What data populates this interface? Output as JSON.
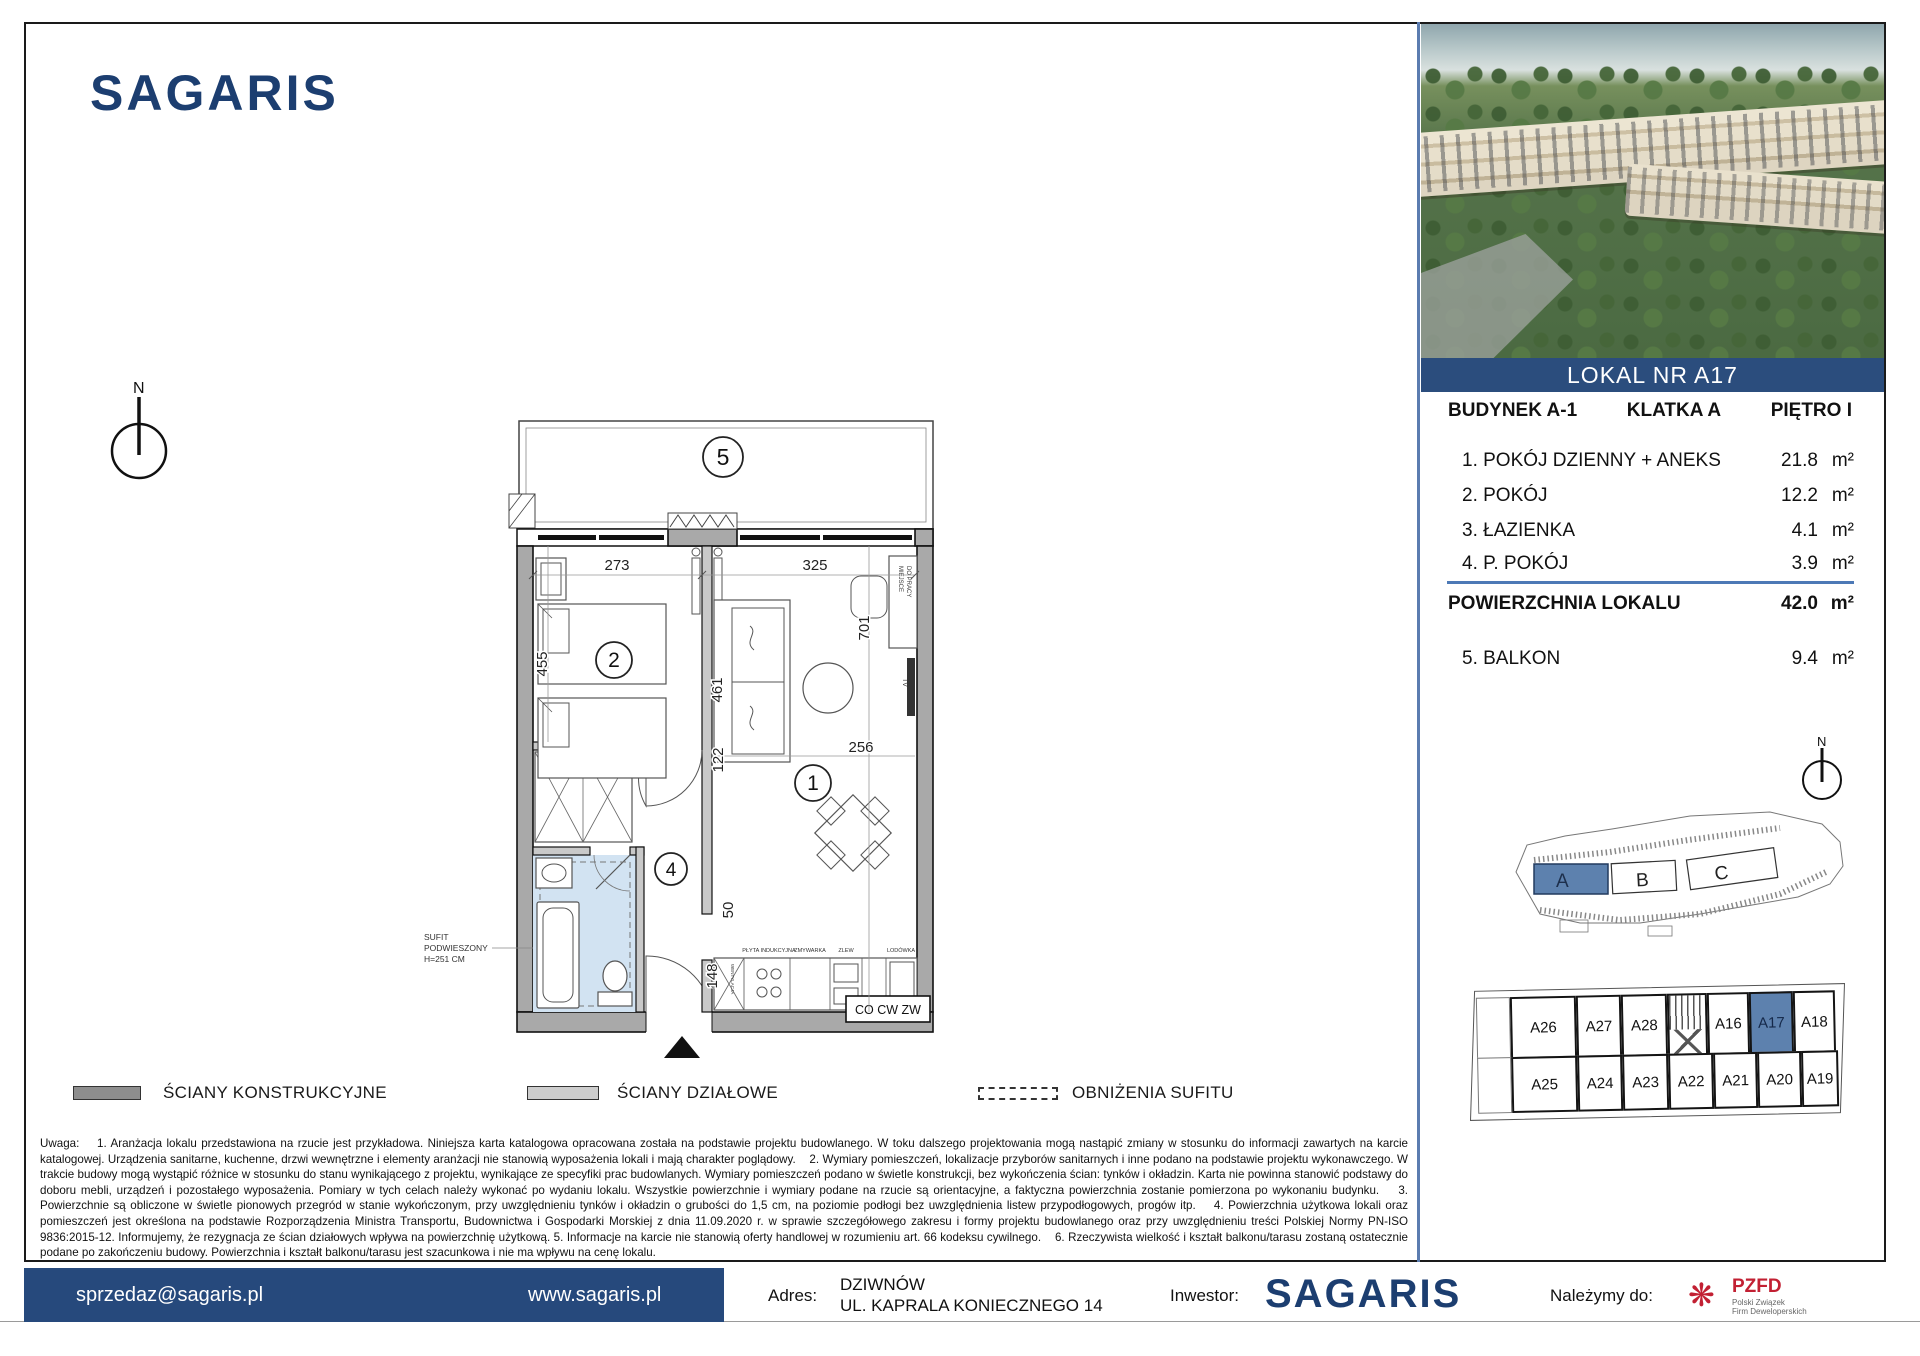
{
  "brand": {
    "name": "SAGARIS"
  },
  "compass": {
    "n": "N"
  },
  "photo": {
    "banner": "LOKAL NR A17"
  },
  "panel": {
    "header": {
      "building": "BUDYNEK A-1",
      "staircase": "KLATKA A",
      "floor": "PIĘTRO I"
    },
    "rooms": [
      {
        "name": "1. POKÓJ DZIENNY + ANEKS",
        "area": "21.8",
        "unit": "m²"
      },
      {
        "name": "2. POKÓJ",
        "area": "12.2",
        "unit": "m²"
      },
      {
        "name": "3. ŁAZIENKA",
        "area": "4.1",
        "unit": "m²"
      },
      {
        "name": "4. P. POKÓJ",
        "area": "3.9",
        "unit": "m²"
      }
    ],
    "total": {
      "label": "POWIERZCHNIA LOKALU",
      "area": "42.0",
      "unit": "m²"
    },
    "balcony": {
      "name": "5. BALKON",
      "area": "9.4",
      "unit": "m²"
    }
  },
  "plan": {
    "labels": {
      "r1": "1",
      "r2": "2",
      "r4": "4",
      "r5": "5"
    },
    "dims": {
      "w_room2": "273",
      "w_room1": "325",
      "h_room2": "455",
      "h_sofa": "461",
      "h_room1": "701",
      "w_hall": "122",
      "w_kitchen": "256",
      "d_50": "50",
      "d_148": "148"
    },
    "notes": {
      "sufit1": "SUFIT",
      "sufit2": "PODWIESZONY",
      "sufit3": "H=251 CM",
      "co": "CO CW ZW",
      "tv": "TV",
      "desk1": "MIEJSCE",
      "desk2": "DO PRACY",
      "vent": "WENTYLACJA",
      "k1": "PŁYTA INDUKCYJNA",
      "k2": "ZMYWARKA",
      "k3": "ZLEW",
      "k4": "LODÓWKA"
    }
  },
  "site": {
    "labels": {
      "a": "A",
      "b": "B",
      "c": "C"
    }
  },
  "grid": {
    "top": [
      "A26",
      "A27",
      "A28",
      "A16",
      "A17",
      "A18"
    ],
    "bottom": [
      "A25",
      "A24",
      "A23",
      "A22",
      "A21",
      "A20",
      "A19"
    ]
  },
  "legend": {
    "items": [
      {
        "label": "ŚCIANY KONSTRUKCYJNE"
      },
      {
        "label": "ŚCIANY DZIAŁOWE"
      },
      {
        "label": "OBNIŻENIA SUFITU"
      }
    ]
  },
  "notes": {
    "text": "Uwaga:    1. Aranżacja lokalu przedstawiona na rzucie jest przykładowa. Niniejsza karta katalogowa opracowana została na podstawie projektu budowlanego. W toku dalszego projektowania mogą nastąpić zmiany w stosunku do informacji zawartych na karcie katalogowej. Urządzenia sanitarne, kuchenne, drzwi wewnętrzne i elementy aranżacji nie stanowią wyposażenia lokali i mają charakter poglądowy.    2. Wymiary pomieszczeń, lokalizacje przyborów sanitarnych i inne podano na podstawie projektu wykonawczego. W trakcie budowy mogą wystąpić różnice w stosunku do stanu wynikającego z projektu, wynikające ze specyfiki prac budowlanych. Wymiary pomieszczeń podano w świetle konstrukcji, bez wykończenia ścian: tynków i okładzin. Karta nie powinna stanowić podstawy do doboru mebli, urządzeń i pozostałego wyposażenia. Pomiary w tych celach należy wykonać po wydaniu lokalu. Wszystkie powierzchnie i wymiary podane na rzucie są orientacyjne, a faktyczna powierzchnia zostanie pomierzona po wykonaniu budynku.    3. Powierzchnie są obliczone w świetle pionowych przegród w stanie wykończonym, przy uwzględnieniu tynków i okładzin o grubości do 1,5 cm, na poziomie podłogi bez uwzględnienia listew przypodłogowych, progów itp.    4. Powierzchnia użytkowa lokali oraz pomieszczeń jest określona na podstawie Rozporządzenia Ministra Transportu, Budownictwa i Gospodarki Morskiej z dnia 11.09.2020 r. w sprawie szczegółowego zakresu i formy projektu budowlanego oraz przy uwzględnieniu treści Polskiej Normy PN-ISO 9836:2015-12. Informujemy, że rezygnacja ze ścian działowych wpływa na powierzchnię użytkową. 5. Informacje na karcie nie stanowią oferty handlowej w rozumieniu art. 66 kodeksu cywilnego.    6. Rzeczywista wielkość i kształt balkonu/tarasu zostaną ostatecznie podane po zakończeniu budowy. Powierzchnia i kształt balkonu/tarasu jest szacunkowa i nie ma wpływu na cenę lokalu."
  },
  "footer": {
    "email": "sprzedaz@sagaris.pl",
    "website": "www.sagaris.pl",
    "address_label": "Adres:",
    "address1": "DZIWNÓW",
    "address2": "UL. KAPRALA KONIECZNEGO 14",
    "investor_label": "Inwestor:",
    "investor_name": "SAGARIS",
    "member_label": "Należymy do:",
    "pzfd_name": "PZFD",
    "pzfd_sub1": "Polski Związek",
    "pzfd_sub2": "Firm Deweloperskich"
  }
}
